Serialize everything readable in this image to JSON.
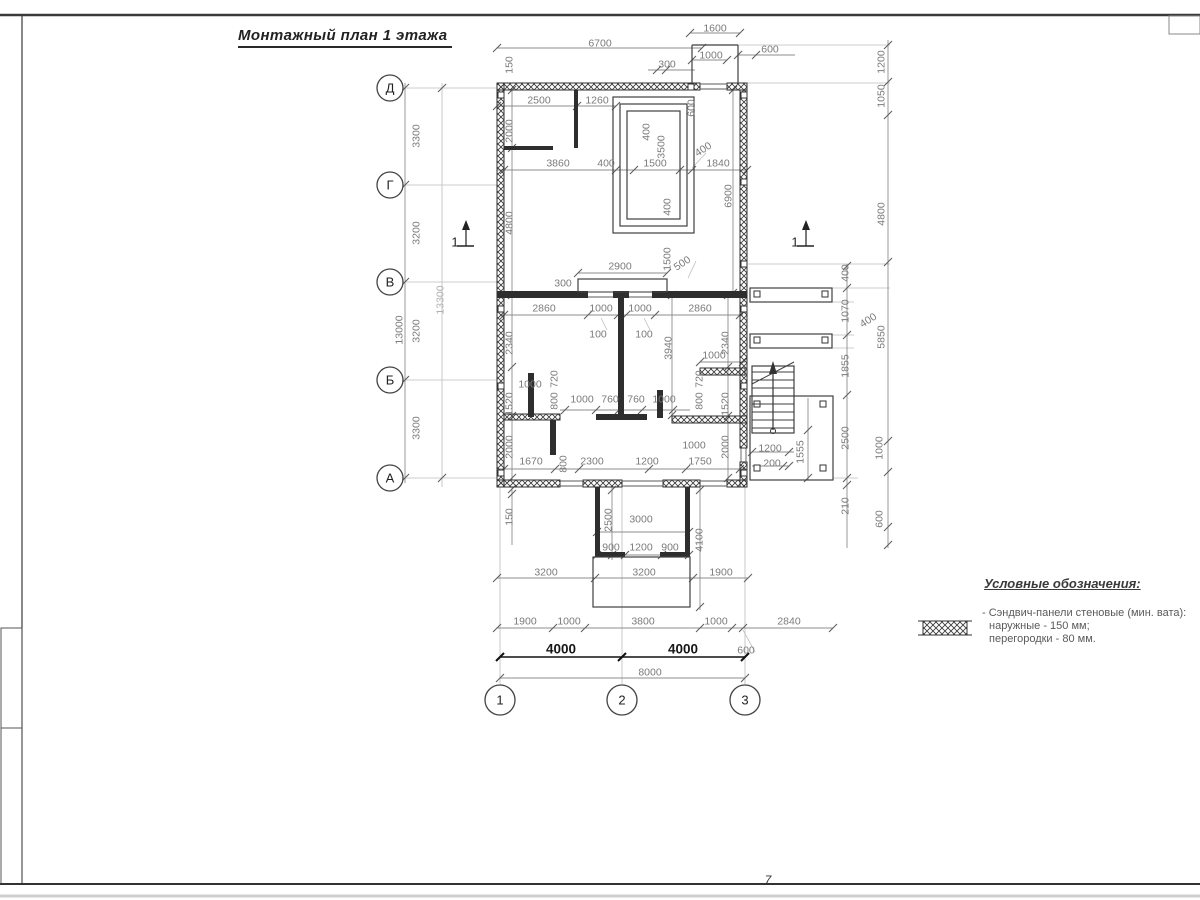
{
  "title": "Монтажный план 1 этажа",
  "sheet": {
    "page_mark": "7"
  },
  "legend": {
    "title": "Условные обозначения:",
    "items": [
      {
        "symbol": "crosshatch-wall-panel",
        "lines": [
          "- Сэндвич-панели стеновые (мин. вата):",
          "наружные - 150 мм;",
          "перегородки - 80 мм."
        ]
      }
    ]
  },
  "axes": {
    "rows": [
      {
        "label": "Д",
        "y": 88
      },
      {
        "label": "Г",
        "y": 185
      },
      {
        "label": "В",
        "y": 282
      },
      {
        "label": "Б",
        "y": 380
      },
      {
        "label": "А",
        "y": 478
      }
    ],
    "cols": [
      {
        "label": "1",
        "x": 500
      },
      {
        "label": "2",
        "x": 622
      },
      {
        "label": "3",
        "x": 745
      }
    ]
  },
  "section_marks": [
    {
      "label": "1",
      "x": 466,
      "y": 234
    },
    {
      "label": "1",
      "x": 806,
      "y": 234
    }
  ],
  "dimensions": [
    {
      "t": "1600",
      "x": 715,
      "y": 28
    },
    {
      "t": "6700",
      "x": 600,
      "y": 43
    },
    {
      "t": "1000",
      "x": 711,
      "y": 55
    },
    {
      "t": "600",
      "x": 770,
      "y": 49
    },
    {
      "t": "300",
      "x": 667,
      "y": 64
    },
    {
      "t": "150",
      "x": 509,
      "y": 65,
      "r": 1
    },
    {
      "t": "2500",
      "x": 539,
      "y": 100
    },
    {
      "t": "1260",
      "x": 597,
      "y": 100
    },
    {
      "t": "2000",
      "x": 509,
      "y": 131,
      "r": 1
    },
    {
      "t": "600",
      "x": 691,
      "y": 108,
      "r": 1
    },
    {
      "t": "3860",
      "x": 558,
      "y": 163
    },
    {
      "t": "400",
      "x": 606,
      "y": 163
    },
    {
      "t": "1500",
      "x": 655,
      "y": 163
    },
    {
      "t": "400",
      "x": 703,
      "y": 149,
      "d": 1
    },
    {
      "t": "1840",
      "x": 718,
      "y": 163
    },
    {
      "t": "400",
      "x": 646,
      "y": 132,
      "r": 1
    },
    {
      "t": "3500",
      "x": 661,
      "y": 147,
      "r": 1
    },
    {
      "t": "400",
      "x": 667,
      "y": 207,
      "r": 1
    },
    {
      "t": "6900",
      "x": 728,
      "y": 196,
      "r": 1
    },
    {
      "t": "4800",
      "x": 509,
      "y": 223,
      "r": 1
    },
    {
      "t": "2900",
      "x": 620,
      "y": 266
    },
    {
      "t": "300",
      "x": 563,
      "y": 283
    },
    {
      "t": "1500",
      "x": 667,
      "y": 259,
      "r": 1
    },
    {
      "t": "500",
      "x": 682,
      "y": 263,
      "d": 1
    },
    {
      "t": "2860",
      "x": 544,
      "y": 308
    },
    {
      "t": "1000",
      "x": 601,
      "y": 308
    },
    {
      "t": "1000",
      "x": 640,
      "y": 308
    },
    {
      "t": "2860",
      "x": 700,
      "y": 308
    },
    {
      "t": "100",
      "x": 598,
      "y": 334
    },
    {
      "t": "100",
      "x": 644,
      "y": 334
    },
    {
      "t": "2340",
      "x": 509,
      "y": 343,
      "r": 1
    },
    {
      "t": "2340",
      "x": 725,
      "y": 343,
      "r": 1
    },
    {
      "t": "3940",
      "x": 668,
      "y": 348,
      "r": 1
    },
    {
      "t": "1000",
      "x": 714,
      "y": 355
    },
    {
      "t": "1000",
      "x": 530,
      "y": 384
    },
    {
      "t": "720",
      "x": 554,
      "y": 379,
      "r": 1
    },
    {
      "t": "800",
      "x": 554,
      "y": 401,
      "r": 1
    },
    {
      "t": "1520",
      "x": 509,
      "y": 404,
      "r": 1
    },
    {
      "t": "2000",
      "x": 509,
      "y": 447,
      "r": 1
    },
    {
      "t": "1000",
      "x": 582,
      "y": 399
    },
    {
      "t": "760",
      "x": 610,
      "y": 399
    },
    {
      "t": "760",
      "x": 636,
      "y": 399
    },
    {
      "t": "1000",
      "x": 664,
      "y": 399
    },
    {
      "t": "720",
      "x": 699,
      "y": 379,
      "r": 1
    },
    {
      "t": "800",
      "x": 699,
      "y": 401,
      "r": 1
    },
    {
      "t": "1520",
      "x": 725,
      "y": 404,
      "r": 1
    },
    {
      "t": "2000",
      "x": 725,
      "y": 447,
      "r": 1
    },
    {
      "t": "1670",
      "x": 531,
      "y": 461
    },
    {
      "t": "800",
      "x": 563,
      "y": 464,
      "r": 1
    },
    {
      "t": "2300",
      "x": 592,
      "y": 461
    },
    {
      "t": "1200",
      "x": 647,
      "y": 461
    },
    {
      "t": "1750",
      "x": 700,
      "y": 461
    },
    {
      "t": "1000",
      "x": 694,
      "y": 445
    },
    {
      "t": "1200",
      "x": 770,
      "y": 448
    },
    {
      "t": "200",
      "x": 772,
      "y": 463
    },
    {
      "t": "1555",
      "x": 800,
      "y": 452,
      "r": 1
    },
    {
      "t": "150",
      "x": 509,
      "y": 517,
      "r": 1
    },
    {
      "t": "2500",
      "x": 608,
      "y": 520,
      "r": 1
    },
    {
      "t": "3000",
      "x": 641,
      "y": 519
    },
    {
      "t": "900",
      "x": 611,
      "y": 547
    },
    {
      "t": "1200",
      "x": 641,
      "y": 547
    },
    {
      "t": "900",
      "x": 670,
      "y": 547
    },
    {
      "t": "4100",
      "x": 699,
      "y": 540,
      "r": 1
    },
    {
      "t": "3300",
      "x": 416,
      "y": 136,
      "r": 1
    },
    {
      "t": "3200",
      "x": 416,
      "y": 233,
      "r": 1
    },
    {
      "t": "3200",
      "x": 416,
      "y": 331,
      "r": 1
    },
    {
      "t": "3300",
      "x": 416,
      "y": 428,
      "r": 1
    },
    {
      "t": "13000",
      "x": 399,
      "y": 330,
      "r": 1
    },
    {
      "t": "13300",
      "x": 440,
      "y": 300,
      "r": 1,
      "l": 1
    },
    {
      "t": "400",
      "x": 845,
      "y": 273,
      "r": 1
    },
    {
      "t": "1070",
      "x": 845,
      "y": 311,
      "r": 1
    },
    {
      "t": "400",
      "x": 868,
      "y": 320,
      "d": 1
    },
    {
      "t": "1855",
      "x": 845,
      "y": 366,
      "r": 1
    },
    {
      "t": "2500",
      "x": 845,
      "y": 438,
      "r": 1
    },
    {
      "t": "1000",
      "x": 879,
      "y": 448,
      "r": 1
    },
    {
      "t": "210",
      "x": 845,
      "y": 506,
      "r": 1
    },
    {
      "t": "600",
      "x": 879,
      "y": 519,
      "r": 1
    },
    {
      "t": "5850",
      "x": 881,
      "y": 337,
      "r": 1
    },
    {
      "t": "4800",
      "x": 881,
      "y": 214,
      "r": 1
    },
    {
      "t": "1050",
      "x": 881,
      "y": 96,
      "r": 1
    },
    {
      "t": "1200",
      "x": 881,
      "y": 62,
      "r": 1
    },
    {
      "t": "3200",
      "x": 546,
      "y": 572
    },
    {
      "t": "3200",
      "x": 644,
      "y": 572
    },
    {
      "t": "1900",
      "x": 721,
      "y": 572
    },
    {
      "t": "1900",
      "x": 525,
      "y": 621
    },
    {
      "t": "1000",
      "x": 569,
      "y": 621
    },
    {
      "t": "3800",
      "x": 643,
      "y": 621
    },
    {
      "t": "1000",
      "x": 716,
      "y": 621
    },
    {
      "t": "600",
      "x": 746,
      "y": 650
    },
    {
      "t": "2840",
      "x": 789,
      "y": 621
    },
    {
      "t": "4000",
      "x": 561,
      "y": 649,
      "b": 1
    },
    {
      "t": "4000",
      "x": 683,
      "y": 649,
      "b": 1
    },
    {
      "t": "8000",
      "x": 650,
      "y": 672
    }
  ]
}
